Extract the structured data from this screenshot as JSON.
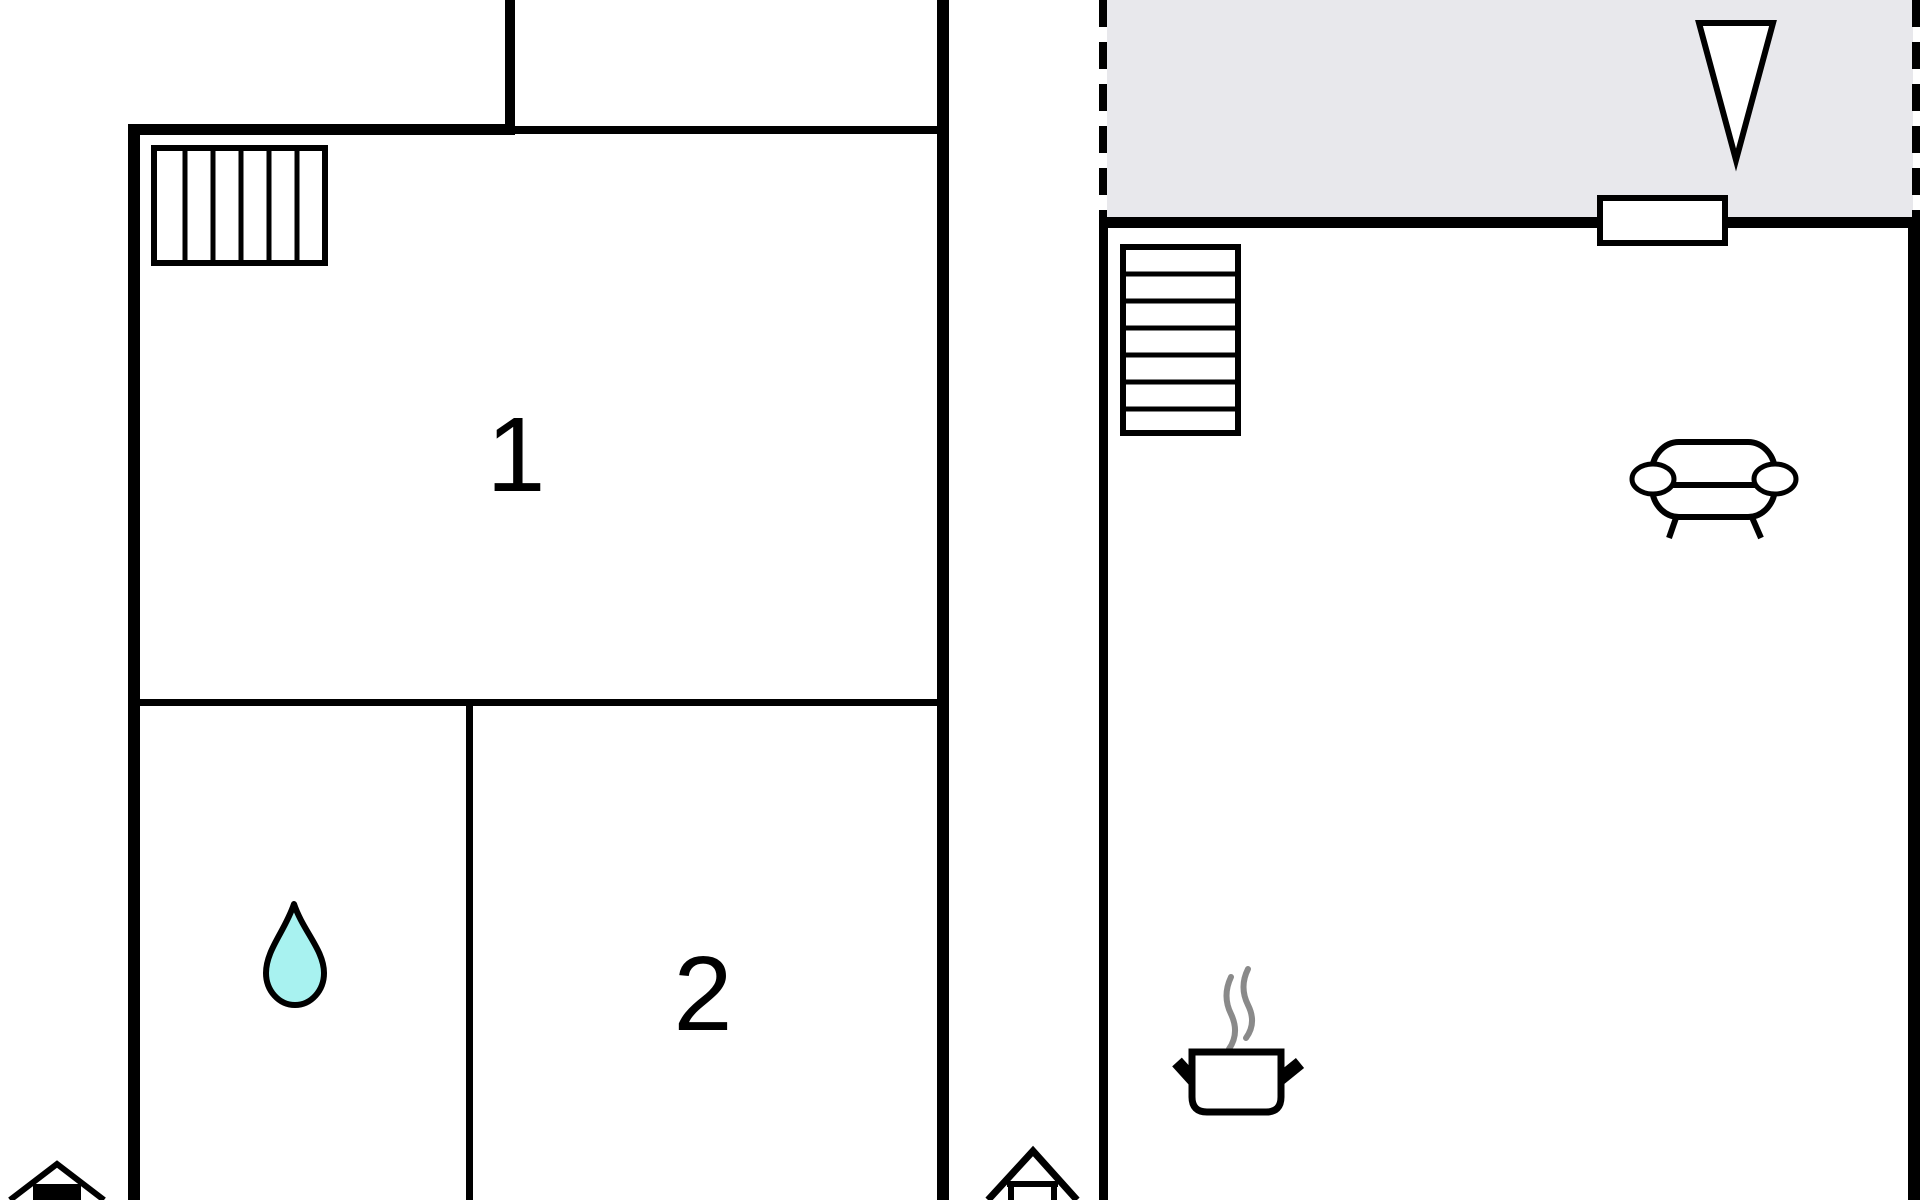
{
  "plan": {
    "description": "Two-unit apartment floor plan",
    "room1_label": "1",
    "room2_label": "2"
  },
  "colors": {
    "background": "#ffffff",
    "wall": "#000000",
    "terrace_fill": "#e8e8ec",
    "water_drop_fill": "#a8f2f0",
    "steam": "#8a8a8a",
    "icon_stroke": "#000000",
    "icon_fill": "#ffffff"
  },
  "icons": {
    "window_hatch": "window-hatch-icon",
    "water_drop": "water-drop-icon",
    "stairs": "stairs-icon",
    "north_arrow": "north-arrow-icon",
    "door": "door-icon",
    "sofa": "sofa-icon",
    "cooking_pot": "cooking-pot-icon",
    "steam": "steam-icon",
    "entrance_left": "entrance-house-icon",
    "entrance_middle": "entrance-house-icon"
  }
}
